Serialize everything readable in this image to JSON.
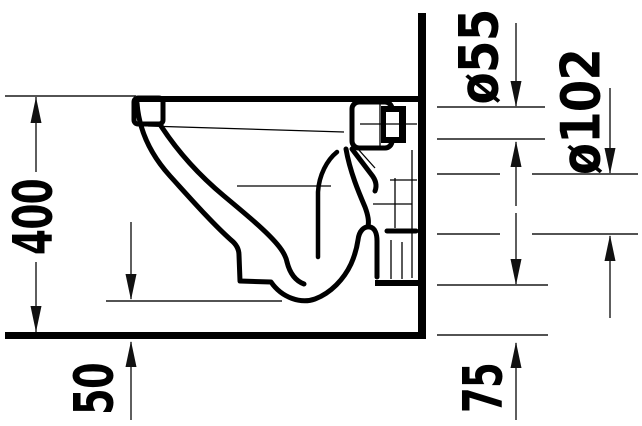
{
  "drawing": {
    "type": "technical-elevation",
    "subject": "wall-hung-toilet-side-view"
  },
  "dimensions": {
    "rim_height": "400",
    "floor_clearance": "50",
    "outlet_height": "75",
    "supply_diameter": "ø55",
    "drain_diameter": "ø102"
  },
  "colors": {
    "line": "#000000",
    "dimension_line": "#1a1a1a",
    "background": "#ffffff"
  }
}
